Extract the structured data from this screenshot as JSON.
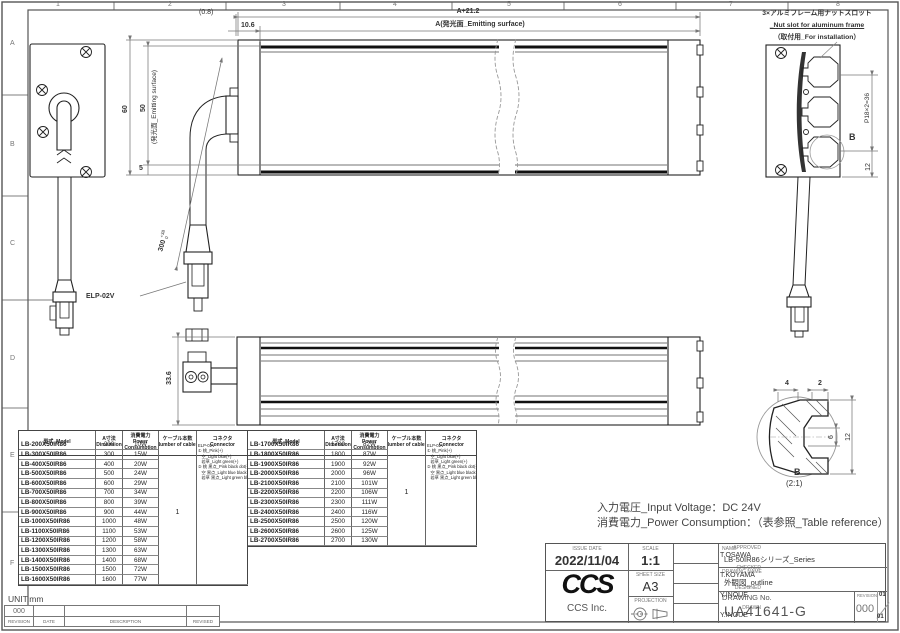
{
  "zones": {
    "top": [
      "1",
      "2",
      "3",
      "4",
      "5",
      "6",
      "7",
      "8"
    ],
    "left": [
      "A",
      "B",
      "C",
      "D",
      "E",
      "F"
    ]
  },
  "dims": {
    "top_offset": "(0.8)",
    "endcap": "10.6",
    "overall": "A+21.2",
    "emitting_top": "A(発光面_Emitting surface)",
    "height60": "60",
    "height50": "50",
    "emitting_side": "(発光面_Emitting surface)",
    "height5": "5",
    "cable_len": "300",
    "cable_tol_plus": "+38",
    "cable_tol_minus": "0",
    "connector_model": "ELP-02V",
    "slot_pitch": "P18×2=36",
    "slot_offset": "12",
    "depth": "33.6",
    "detail_4": "4",
    "detail_2": "2",
    "detail_6": "6",
    "detail_12": "12"
  },
  "notes": {
    "nut_slot_line1": "3×アルミフレーム用ナットスロット",
    "nut_slot_line2": "_Nut slot for aluminum frame",
    "nut_slot_line3": "（取付用_For installation）",
    "section_mark": "B",
    "detail_label": "B",
    "detail_scale": "(2:1)",
    "input_voltage": "入力電圧_Input Voltage：DC 24V",
    "power_note": "消費電力_Power Consumption：（表参照_Table reference）",
    "unit": "UNIT:mm"
  },
  "tables": {
    "headers": {
      "model": "型式_Model",
      "dimension": "A寸法\nDimension",
      "power": "消費電力\nPower\nConsumption",
      "cables": "ケーブル本数\nNumber of cables",
      "connector": "コネクタ\nConnector"
    },
    "cables_value": "1",
    "connector_text": "ELP-02V\n① 桃_Pink(+)\n   空_Light blue(+)\n   若草_Light green(+)\n② 桃 黒点_Pink black dot(-)\n   空 黒点_Light blue black dot(-)\n   若草 黒点_Light green black dot(-)",
    "left": {
      "rows": [
        {
          "model": "LB-200X50IR86",
          "dim": "200",
          "power": "10W"
        },
        {
          "model": "LB-300X50IR86",
          "dim": "300",
          "power": "15W"
        },
        {
          "model": "LB-400X50IR86",
          "dim": "400",
          "power": "20W"
        },
        {
          "model": "LB-500X50IR86",
          "dim": "500",
          "power": "24W"
        },
        {
          "model": "LB-600X50IR86",
          "dim": "600",
          "power": "29W"
        },
        {
          "model": "LB-700X50IR86",
          "dim": "700",
          "power": "34W"
        },
        {
          "model": "LB-800X50IR86",
          "dim": "800",
          "power": "39W"
        },
        {
          "model": "LB-900X50IR86",
          "dim": "900",
          "power": "44W"
        },
        {
          "model": "LB-1000X50IR86",
          "dim": "1000",
          "power": "48W"
        },
        {
          "model": "LB-1100X50IR86",
          "dim": "1100",
          "power": "53W"
        },
        {
          "model": "LB-1200X50IR86",
          "dim": "1200",
          "power": "58W"
        },
        {
          "model": "LB-1300X50IR86",
          "dim": "1300",
          "power": "63W"
        },
        {
          "model": "LB-1400X50IR86",
          "dim": "1400",
          "power": "68W"
        },
        {
          "model": "LB-1500X50IR86",
          "dim": "1500",
          "power": "72W"
        },
        {
          "model": "LB-1600X50IR86",
          "dim": "1600",
          "power": "77W"
        }
      ]
    },
    "right": {
      "rows": [
        {
          "model": "LB-1700X50IR86",
          "dim": "1700",
          "power": "82W"
        },
        {
          "model": "LB-1800X50IR86",
          "dim": "1800",
          "power": "87W"
        },
        {
          "model": "LB-1900X50IR86",
          "dim": "1900",
          "power": "92W"
        },
        {
          "model": "LB-2000X50IR86",
          "dim": "2000",
          "power": "96W"
        },
        {
          "model": "LB-2100X50IR86",
          "dim": "2100",
          "power": "101W"
        },
        {
          "model": "LB-2200X50IR86",
          "dim": "2200",
          "power": "106W"
        },
        {
          "model": "LB-2300X50IR86",
          "dim": "2300",
          "power": "111W"
        },
        {
          "model": "LB-2400X50IR86",
          "dim": "2400",
          "power": "116W"
        },
        {
          "model": "LB-2500X50IR86",
          "dim": "2500",
          "power": "120W"
        },
        {
          "model": "LB-2600X50IR86",
          "dim": "2600",
          "power": "125W"
        },
        {
          "model": "LB-2700X50IR86",
          "dim": "2700",
          "power": "130W"
        }
      ]
    }
  },
  "title_block": {
    "issue_date_label": "ISSUE DATE",
    "issue_date": "2022/11/04",
    "scale_label": "SCALE",
    "scale": "1:1",
    "sheet_label": "SHEET SIZE",
    "sheet": "A3",
    "projection_label": "PROJECTION",
    "approved_label": "APPROVED",
    "approved": "T.OSAWA",
    "checked_label": "CHECKED",
    "checked": "T.KOYAMA",
    "designed_label": "DESIGNED",
    "designed": "Y.INOUE",
    "drawn_label": "DRAWN",
    "drawn": "Y.INOUE",
    "name_label": "NAME",
    "name": "LB-50IR86シリーズ_Series",
    "drawing_name_label": "DRAWING NAME",
    "drawing_name": "外観図_outline",
    "drawing_no_label": "DRAWING No.",
    "drawing_no": "UA41641-G",
    "revision_label": "REVISION",
    "revision": "000",
    "rev_mark_top": "01",
    "rev_mark_bottom": "01",
    "logo_text": "CCS",
    "company": "CCS Inc."
  },
  "revision_strip": {
    "value": "000",
    "headers": [
      "REVISION",
      "DATE",
      "DESCRIPTION",
      "REVISED"
    ]
  }
}
